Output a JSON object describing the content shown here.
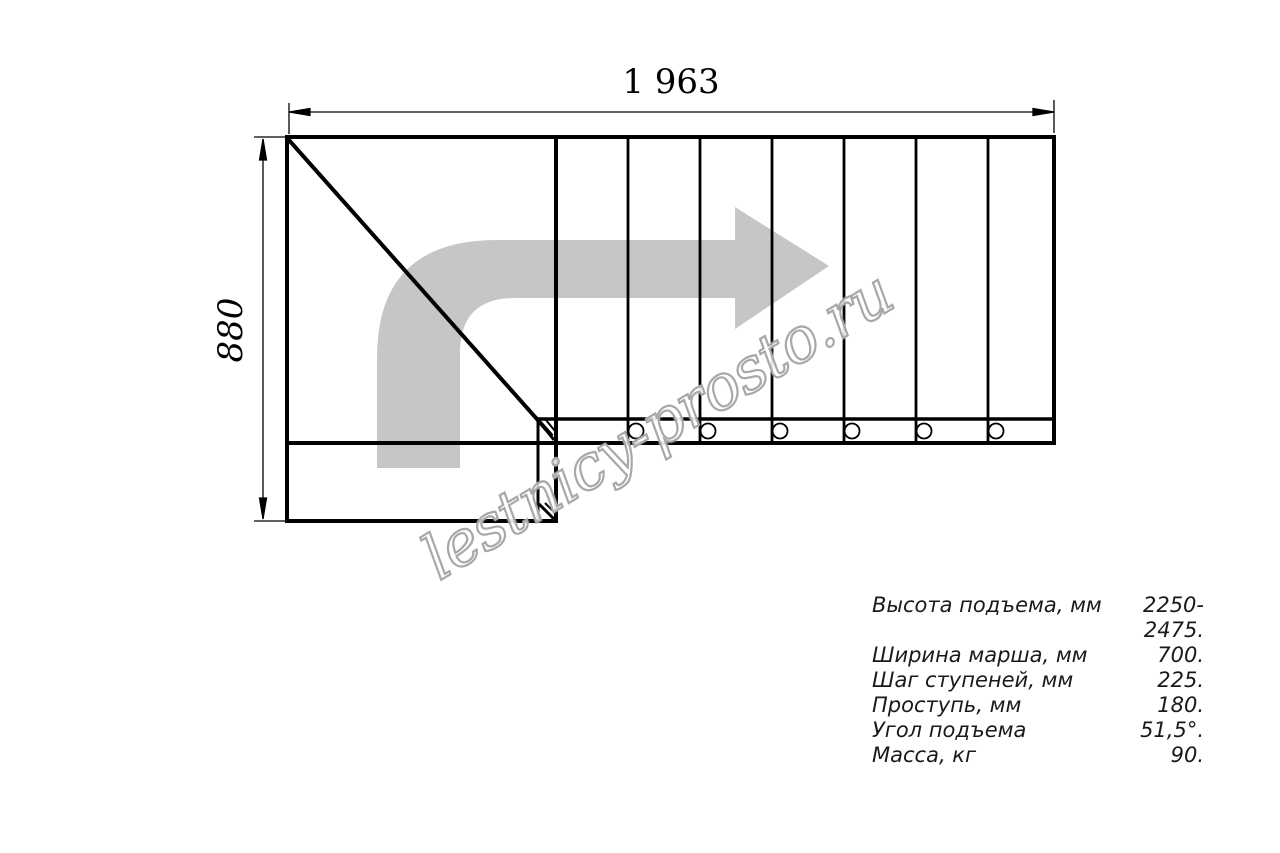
{
  "drawing": {
    "top_dimension": "1 963",
    "left_dimension": "880",
    "watermark": "lestnicy-prosto.ru"
  },
  "specs": {
    "rows": [
      {
        "label": "Высота подъема, мм",
        "value": "2250-2475."
      },
      {
        "label": "Ширина марша, мм",
        "value": "700."
      },
      {
        "label": "Шаг ступеней, мм",
        "value": "225."
      },
      {
        "label": "Проступь, мм",
        "value": "180."
      },
      {
        "label": "Угол подъема",
        "value": "51,5°."
      },
      {
        "label": "Масса, кг",
        "value": "90."
      }
    ]
  },
  "colors": {
    "line": "#000000",
    "direction_arrow": "#c6c6c6",
    "watermark_stroke": "#a8a8a8",
    "text": "#1a1a1a"
  }
}
